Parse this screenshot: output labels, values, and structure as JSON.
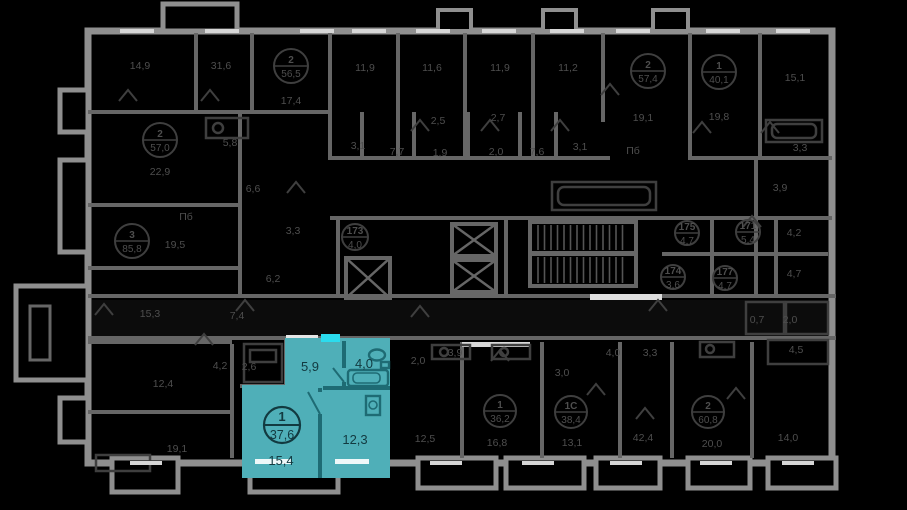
{
  "plan": {
    "title": "floor-plan",
    "colors": {
      "background": "#000000",
      "walls": "#8f8f8f",
      "partitions": "#666666",
      "dim_text": "#4e4e4e",
      "highlight_fill": "#4FAFB8",
      "highlight_walls": "#1E6B74",
      "highlight_text": "#123a40",
      "entrance_door": "#2BDCEE"
    },
    "highlight": {
      "badge": {
        "rooms_count": "1",
        "total_area": "37,6"
      },
      "room_labels": [
        {
          "text": "5,9",
          "x": 310,
          "y": 371
        },
        {
          "text": "4,0",
          "x": 364,
          "y": 368
        },
        {
          "text": "12,3",
          "x": 355,
          "y": 444
        },
        {
          "text": "15,4",
          "x": 281,
          "y": 465
        }
      ],
      "entrance_door_marker": "entrance-door"
    },
    "dim_room_labels": [
      {
        "text": "14,9",
        "x": 140,
        "y": 69
      },
      {
        "text": "31,6",
        "x": 221,
        "y": 69
      },
      {
        "text": "17,4",
        "x": 291,
        "y": 104
      },
      {
        "text": "11,9",
        "x": 365,
        "y": 71
      },
      {
        "text": "11,6",
        "x": 432,
        "y": 71
      },
      {
        "text": "11,9",
        "x": 500,
        "y": 71
      },
      {
        "text": "11,2",
        "x": 568,
        "y": 71
      },
      {
        "text": "19,1",
        "x": 643,
        "y": 121
      },
      {
        "text": "19,8",
        "x": 719,
        "y": 120
      },
      {
        "text": "15,1",
        "x": 795,
        "y": 81
      },
      {
        "text": "2,5",
        "x": 438,
        "y": 124
      },
      {
        "text": "2,7",
        "x": 498,
        "y": 121
      },
      {
        "text": "3,1",
        "x": 358,
        "y": 149
      },
      {
        "text": "3,1",
        "x": 580,
        "y": 150
      },
      {
        "text": "7,7",
        "x": 397,
        "y": 155
      },
      {
        "text": "1,9",
        "x": 440,
        "y": 156
      },
      {
        "text": "2,0",
        "x": 496,
        "y": 155
      },
      {
        "text": "7,6",
        "x": 537,
        "y": 155
      },
      {
        "text": "Пб",
        "x": 633,
        "y": 154
      },
      {
        "text": "22,9",
        "x": 160,
        "y": 175
      },
      {
        "text": "5,8",
        "x": 230,
        "y": 146
      },
      {
        "text": "6,6",
        "x": 253,
        "y": 192
      },
      {
        "text": "Пб",
        "x": 186,
        "y": 220
      },
      {
        "text": "19,5",
        "x": 175,
        "y": 248
      },
      {
        "text": "15,3",
        "x": 150,
        "y": 317
      },
      {
        "text": "12,4",
        "x": 163,
        "y": 387
      },
      {
        "text": "19,1",
        "x": 177,
        "y": 452
      },
      {
        "text": "3,3",
        "x": 293,
        "y": 234
      },
      {
        "text": "6,2",
        "x": 273,
        "y": 282
      },
      {
        "text": "7,4",
        "x": 237,
        "y": 319
      },
      {
        "text": "4,2",
        "x": 220,
        "y": 369
      },
      {
        "text": "2,6",
        "x": 249,
        "y": 370
      },
      {
        "text": "3,3",
        "x": 800,
        "y": 151
      },
      {
        "text": "3,9",
        "x": 780,
        "y": 191
      },
      {
        "text": "4,2",
        "x": 794,
        "y": 236
      },
      {
        "text": "4,7",
        "x": 794,
        "y": 277
      },
      {
        "text": "0,7",
        "x": 757,
        "y": 323
      },
      {
        "text": "2,0",
        "x": 790,
        "y": 323
      },
      {
        "text": "4,5",
        "x": 796,
        "y": 353
      },
      {
        "text": "3,9",
        "x": 455,
        "y": 356
      },
      {
        "text": "2,0",
        "x": 418,
        "y": 364
      },
      {
        "text": "12,5",
        "x": 425,
        "y": 442
      },
      {
        "text": "16,8",
        "x": 497,
        "y": 446
      },
      {
        "text": "3,0",
        "x": 562,
        "y": 376
      },
      {
        "text": "13,1",
        "x": 572,
        "y": 446
      },
      {
        "text": "4,0",
        "x": 613,
        "y": 356
      },
      {
        "text": "3,3",
        "x": 650,
        "y": 356
      },
      {
        "text": "42,4",
        "x": 643,
        "y": 441
      },
      {
        "text": "20,0",
        "x": 712,
        "y": 447
      },
      {
        "text": "14,0",
        "x": 788,
        "y": 441
      }
    ],
    "dim_badges": [
      {
        "num": "2",
        "area": "56,5",
        "x": 291,
        "y": 66,
        "r": 17
      },
      {
        "num": "2",
        "area": "57,0",
        "x": 160,
        "y": 140,
        "r": 17
      },
      {
        "num": "2",
        "area": "57,4",
        "x": 648,
        "y": 71,
        "r": 17
      },
      {
        "num": "1",
        "area": "40,1",
        "x": 719,
        "y": 72,
        "r": 17
      },
      {
        "num": "3",
        "area": "85,8",
        "x": 132,
        "y": 241,
        "r": 17
      },
      {
        "num": "173",
        "area": "4,0",
        "x": 355,
        "y": 237,
        "r": 13
      },
      {
        "num": "175",
        "area": "4,7",
        "x": 687,
        "y": 233,
        "r": 12
      },
      {
        "num": "171",
        "area": "5,4",
        "x": 748,
        "y": 232,
        "r": 12
      },
      {
        "num": "174",
        "area": "3,6",
        "x": 673,
        "y": 277,
        "r": 12
      },
      {
        "num": "177",
        "area": "4,7",
        "x": 725,
        "y": 278,
        "r": 12
      },
      {
        "num": "1",
        "area": "36,2",
        "x": 500,
        "y": 411,
        "r": 16
      },
      {
        "num": "1С",
        "area": "38,4",
        "x": 571,
        "y": 412,
        "r": 16
      },
      {
        "num": "2",
        "area": "60,8",
        "x": 708,
        "y": 412,
        "r": 16
      }
    ]
  }
}
